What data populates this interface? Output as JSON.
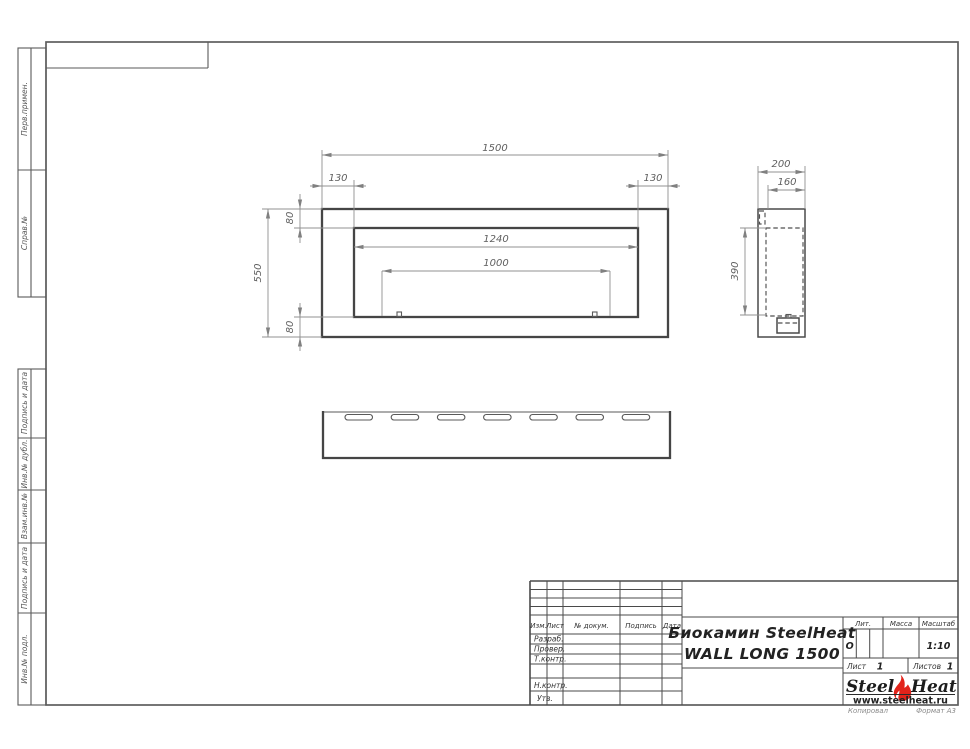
{
  "sheet": {
    "left_stamps": {
      "perv_primen": "Перв.примен.",
      "sprav_no": "Справ.№",
      "podpis_i_data_top": "Подпись и дата",
      "inv_no_dubl": "Инв.№ дубл.",
      "vzam_inv_no": "Взам.инв.№",
      "podpis_i_data_bottom": "Подпись и дата",
      "inv_no_podl": "Инв.№ подл."
    },
    "footer": {
      "kopiroval": "Копировал",
      "format": "Формат А3"
    }
  },
  "drawing": {
    "front_view": {
      "width": "1500",
      "offset_left": "130",
      "offset_right": "130",
      "offset_top": "80",
      "offset_bottom": "80",
      "height": "550",
      "glass_width": "1240",
      "burner_width": "1000"
    },
    "side_view": {
      "depth": "200",
      "inner_depth": "160",
      "height": "390"
    }
  },
  "title_block": {
    "revision_headers": {
      "izm": "Изм.",
      "list": "Лист",
      "doc_no": "№ докум.",
      "podpis": "Подпись",
      "data": "Дата"
    },
    "signature_rows": {
      "razrab": "Разраб.",
      "prover": "Провер.",
      "t_kontr": "Т.контр.",
      "n_kontr": "Н.контр.",
      "utv": "Утв."
    },
    "doc_title_line1": "Биокамин SteelHeat",
    "doc_title_line2": "WALL LONG 1500",
    "lit": {
      "label": "Лит.",
      "value": "О"
    },
    "massa": {
      "label": "Масса"
    },
    "masshtab": {
      "label": "Масштаб",
      "value": "1:10"
    },
    "sheet_no": {
      "label": "Лист",
      "value": "1"
    },
    "sheets_total": {
      "label": "Листов",
      "value": "1"
    },
    "logo": {
      "steel": "Steel",
      "heat": "Heat",
      "site": "www.steelheat.ru"
    }
  },
  "colors": {
    "line": "#4a4a4a",
    "dim_line": "#909090",
    "flame_red": "#e2231a"
  }
}
